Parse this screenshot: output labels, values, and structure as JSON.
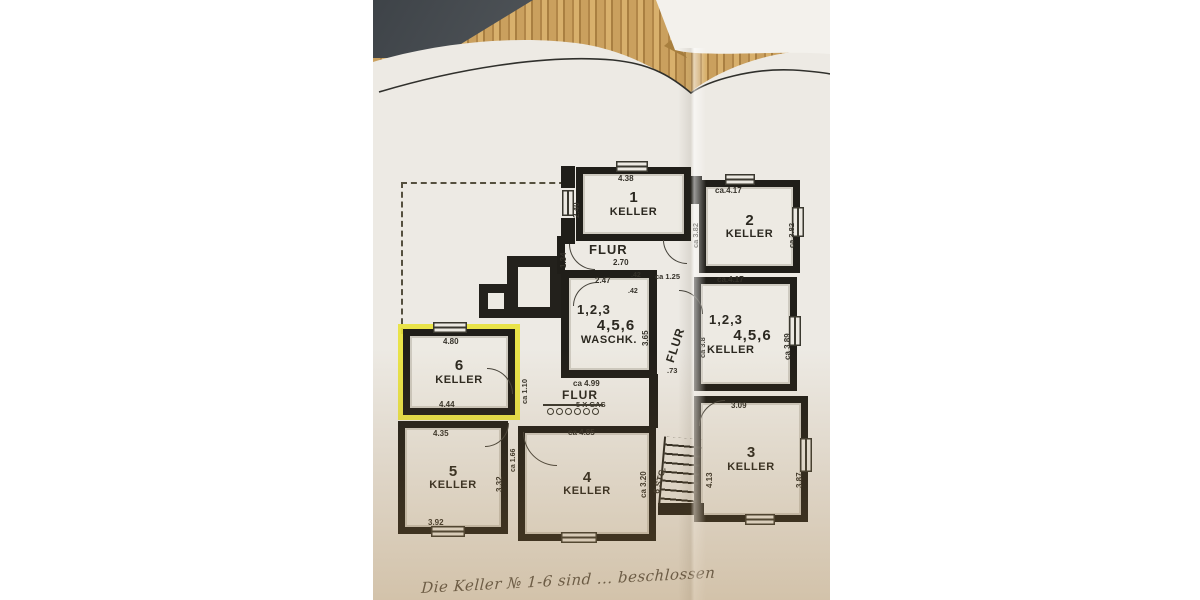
{
  "photo": {
    "handwritten_note": "Die Keller № 1-6 sind ... beschlossen"
  },
  "colors": {
    "wall": "#201e19",
    "paper": "#edeae3",
    "highlight_yellow": "#e8e23c",
    "bamboo": "#c49a58"
  },
  "plan": {
    "room1": {
      "number": "1",
      "label": "KELLER",
      "dim_top": "4.38",
      "dim_left": "2.40"
    },
    "room2": {
      "number": "2",
      "label": "KELLER",
      "dim_top": "ca.4.17",
      "dim_bottom": "ca.4.17",
      "dim_left": "ca 3.82",
      "dim_right": "ca 3.82"
    },
    "flur_top": {
      "label": "FLUR",
      "dim": "2.70",
      "dim_left": "1.34"
    },
    "mid_dims": {
      "d1": "2.47",
      "d2": ".42",
      "d3": ".42",
      "d4": "ca 1.25"
    },
    "waschk": {
      "line1": "1,2,3",
      "line2": "4,5,6",
      "label": "WASCHK.",
      "dim_right": "3.65"
    },
    "keller_shared": {
      "line1": "1,2,3",
      "line2": "4,5,6",
      "label": "KELLER",
      "dim_left": "ca 3.8",
      "dim_right": "ca 3.89"
    },
    "room6": {
      "number": "6",
      "label": "KELLER",
      "dim_top": "4.80",
      "dim_bottom": "4.44"
    },
    "flur_mid": {
      "label": "FLUR",
      "dim_top": "ca 4.99",
      "gas": "5 X GAS",
      "dim_left": "ca 1.10"
    },
    "flur_vert": {
      "label": "FLUR",
      "dim_door": ".73"
    },
    "stairs": {
      "label": "6 STG."
    },
    "room5": {
      "number": "5",
      "label": "KELLER",
      "dim_top": "4.35",
      "dim_bottom": "3.92",
      "dim_right": "3.32",
      "dim_outer": "ca 1.66"
    },
    "room4": {
      "number": "4",
      "label": "KELLER",
      "dim_top": "ca 4.85",
      "dim_right": "ca 3.20"
    },
    "room3": {
      "number": "3",
      "label": "KELLER",
      "dim_top": "3.09",
      "dim_left": "4.13",
      "dim_right": "3.87"
    }
  }
}
